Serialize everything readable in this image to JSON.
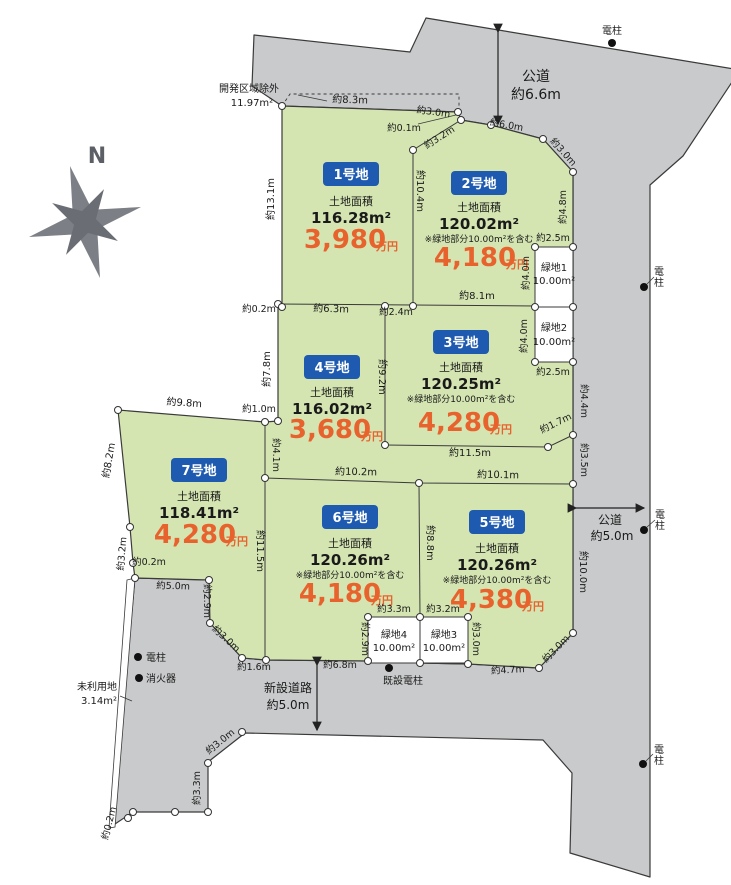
{
  "compass": {
    "north": "N"
  },
  "roads": {
    "top": {
      "name": "公道",
      "width": "約6.6m"
    },
    "right": {
      "name": "公道",
      "width": "約5.0m"
    },
    "new": {
      "name": "新設道路",
      "width": "約5.0m"
    }
  },
  "labels": {
    "exclusion_1": "開発区域除外",
    "exclusion_2": "11.97m²",
    "unused_1": "未利用地",
    "unused_2": "3.14m²",
    "pole": "電柱",
    "pole_v1": "電",
    "pole_v2": "柱",
    "extinguisher": "消火器",
    "existing_pole": "既設電柱"
  },
  "lots": [
    {
      "label": "1号地",
      "area_title": "土地面積",
      "area": "116.28m²",
      "price": "3,980",
      "unit": "万円"
    },
    {
      "label": "2号地",
      "area_title": "土地面積",
      "area": "120.02m²",
      "note": "※緑地部分10.00m²を含む",
      "price": "4,180",
      "unit": "万円"
    },
    {
      "label": "3号地",
      "area_title": "土地面積",
      "area": "120.25m²",
      "note": "※緑地部分10.00m²を含む",
      "price": "4,280",
      "unit": "万円"
    },
    {
      "label": "4号地",
      "area_title": "土地面積",
      "area": "116.02m²",
      "price": "3,680",
      "unit": "万円"
    },
    {
      "label": "5号地",
      "area_title": "土地面積",
      "area": "120.26m²",
      "note": "※緑地部分10.00m²を含む",
      "price": "4,380",
      "unit": "万円"
    },
    {
      "label": "6号地",
      "area_title": "土地面積",
      "area": "120.26m²",
      "note": "※緑地部分10.00m²を含む",
      "price": "4,180",
      "unit": "万円"
    },
    {
      "label": "7号地",
      "area_title": "土地面積",
      "area": "118.41m²",
      "price": "4,280",
      "unit": "万円"
    }
  ],
  "green_spaces": [
    {
      "label": "緑地1",
      "area": "10.00m²"
    },
    {
      "label": "緑地2",
      "area": "10.00m²"
    },
    {
      "label": "緑地3",
      "area": "10.00m²"
    },
    {
      "label": "緑地4",
      "area": "10.00m²"
    }
  ],
  "dims": {
    "m0_1": "約0.1m",
    "m0_2": "約0.2m",
    "m1_0": "約1.0m",
    "m1_6": "約1.6m",
    "m1_7": "約1.7m",
    "m2_4": "約2.4m",
    "m2_5": "約2.5m",
    "m2_9": "約2.9m",
    "m3_0": "約3.0m",
    "m3_2": "約3.2m",
    "m3_3": "約3.3m",
    "m3_5": "約3.5m",
    "m4_0": "約4.0m",
    "m4_1": "約4.1m",
    "m4_4": "約4.4m",
    "m4_7": "約4.7m",
    "m4_8": "約4.8m",
    "m5_0": "約5.0m",
    "m6_0": "約6.0m",
    "m6_3": "約6.3m",
    "m6_8": "約6.8m",
    "m7_8": "約7.8m",
    "m8_1": "約8.1m",
    "m8_2": "約8.2m",
    "m8_3": "約8.3m",
    "m8_8": "約8.8m",
    "m9_2": "約9.2m",
    "m9_8": "約9.8m",
    "m10_0": "約10.0m",
    "m10_1": "約10.1m",
    "m10_2": "約10.2m",
    "m10_4": "約10.4m",
    "m11_5": "約11.5m",
    "m13_1": "約13.1m"
  },
  "colors": {
    "road": "#c9cacb",
    "lot_green": "#d4e5b2",
    "badge_blue": "#1d5ab0",
    "price_orange": "#e8622d"
  }
}
